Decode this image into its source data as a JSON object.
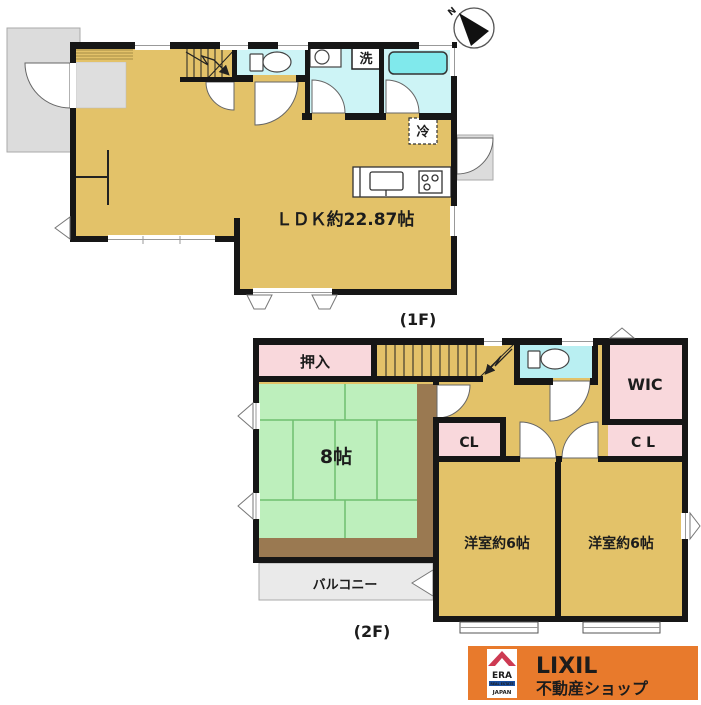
{
  "floor1": {
    "floor_label": "(1F)",
    "ldk_label": "ＬＤＫ約22.87帖",
    "laundry_symbol": "洗",
    "refrigerator_symbol": "冷"
  },
  "floor2": {
    "floor_label": "(2F)",
    "oshiire_label": "押入",
    "tatami_size_label": "8帖",
    "wic_label": "WIC",
    "closet_left_label": "CL",
    "closet_right_label": "C L",
    "bedroom_left_label": "洋室約6帖",
    "bedroom_right_label": "洋室約6帖",
    "balcony_label": "バルコニー"
  },
  "compass": {
    "north_label": "N"
  },
  "branding": {
    "era_logo_text": "ERA",
    "era_tagline": "REAL ESTATE",
    "era_country": "JAPAN",
    "company_name": "LIXIL",
    "shop_name": "不動産ショップ"
  },
  "colors": {
    "floor_tan": "#E3C269",
    "wet_area_cyan": "#CDF4F6",
    "bathtub_cyan": "#80E9EC",
    "closet_pink": "#F9D8DC",
    "tatami_green": "#BDEFBC",
    "tatami_line_green": "#6FBF6F",
    "engawa_brown": "#9A7951",
    "porch_gray": "#DCDCDC",
    "balcony_gray": "#EAEAEA",
    "wall_black": "#161616",
    "banner_orange": "#E87A2C",
    "era_red": "#D6263E",
    "era_blue": "#1A4FA0"
  }
}
